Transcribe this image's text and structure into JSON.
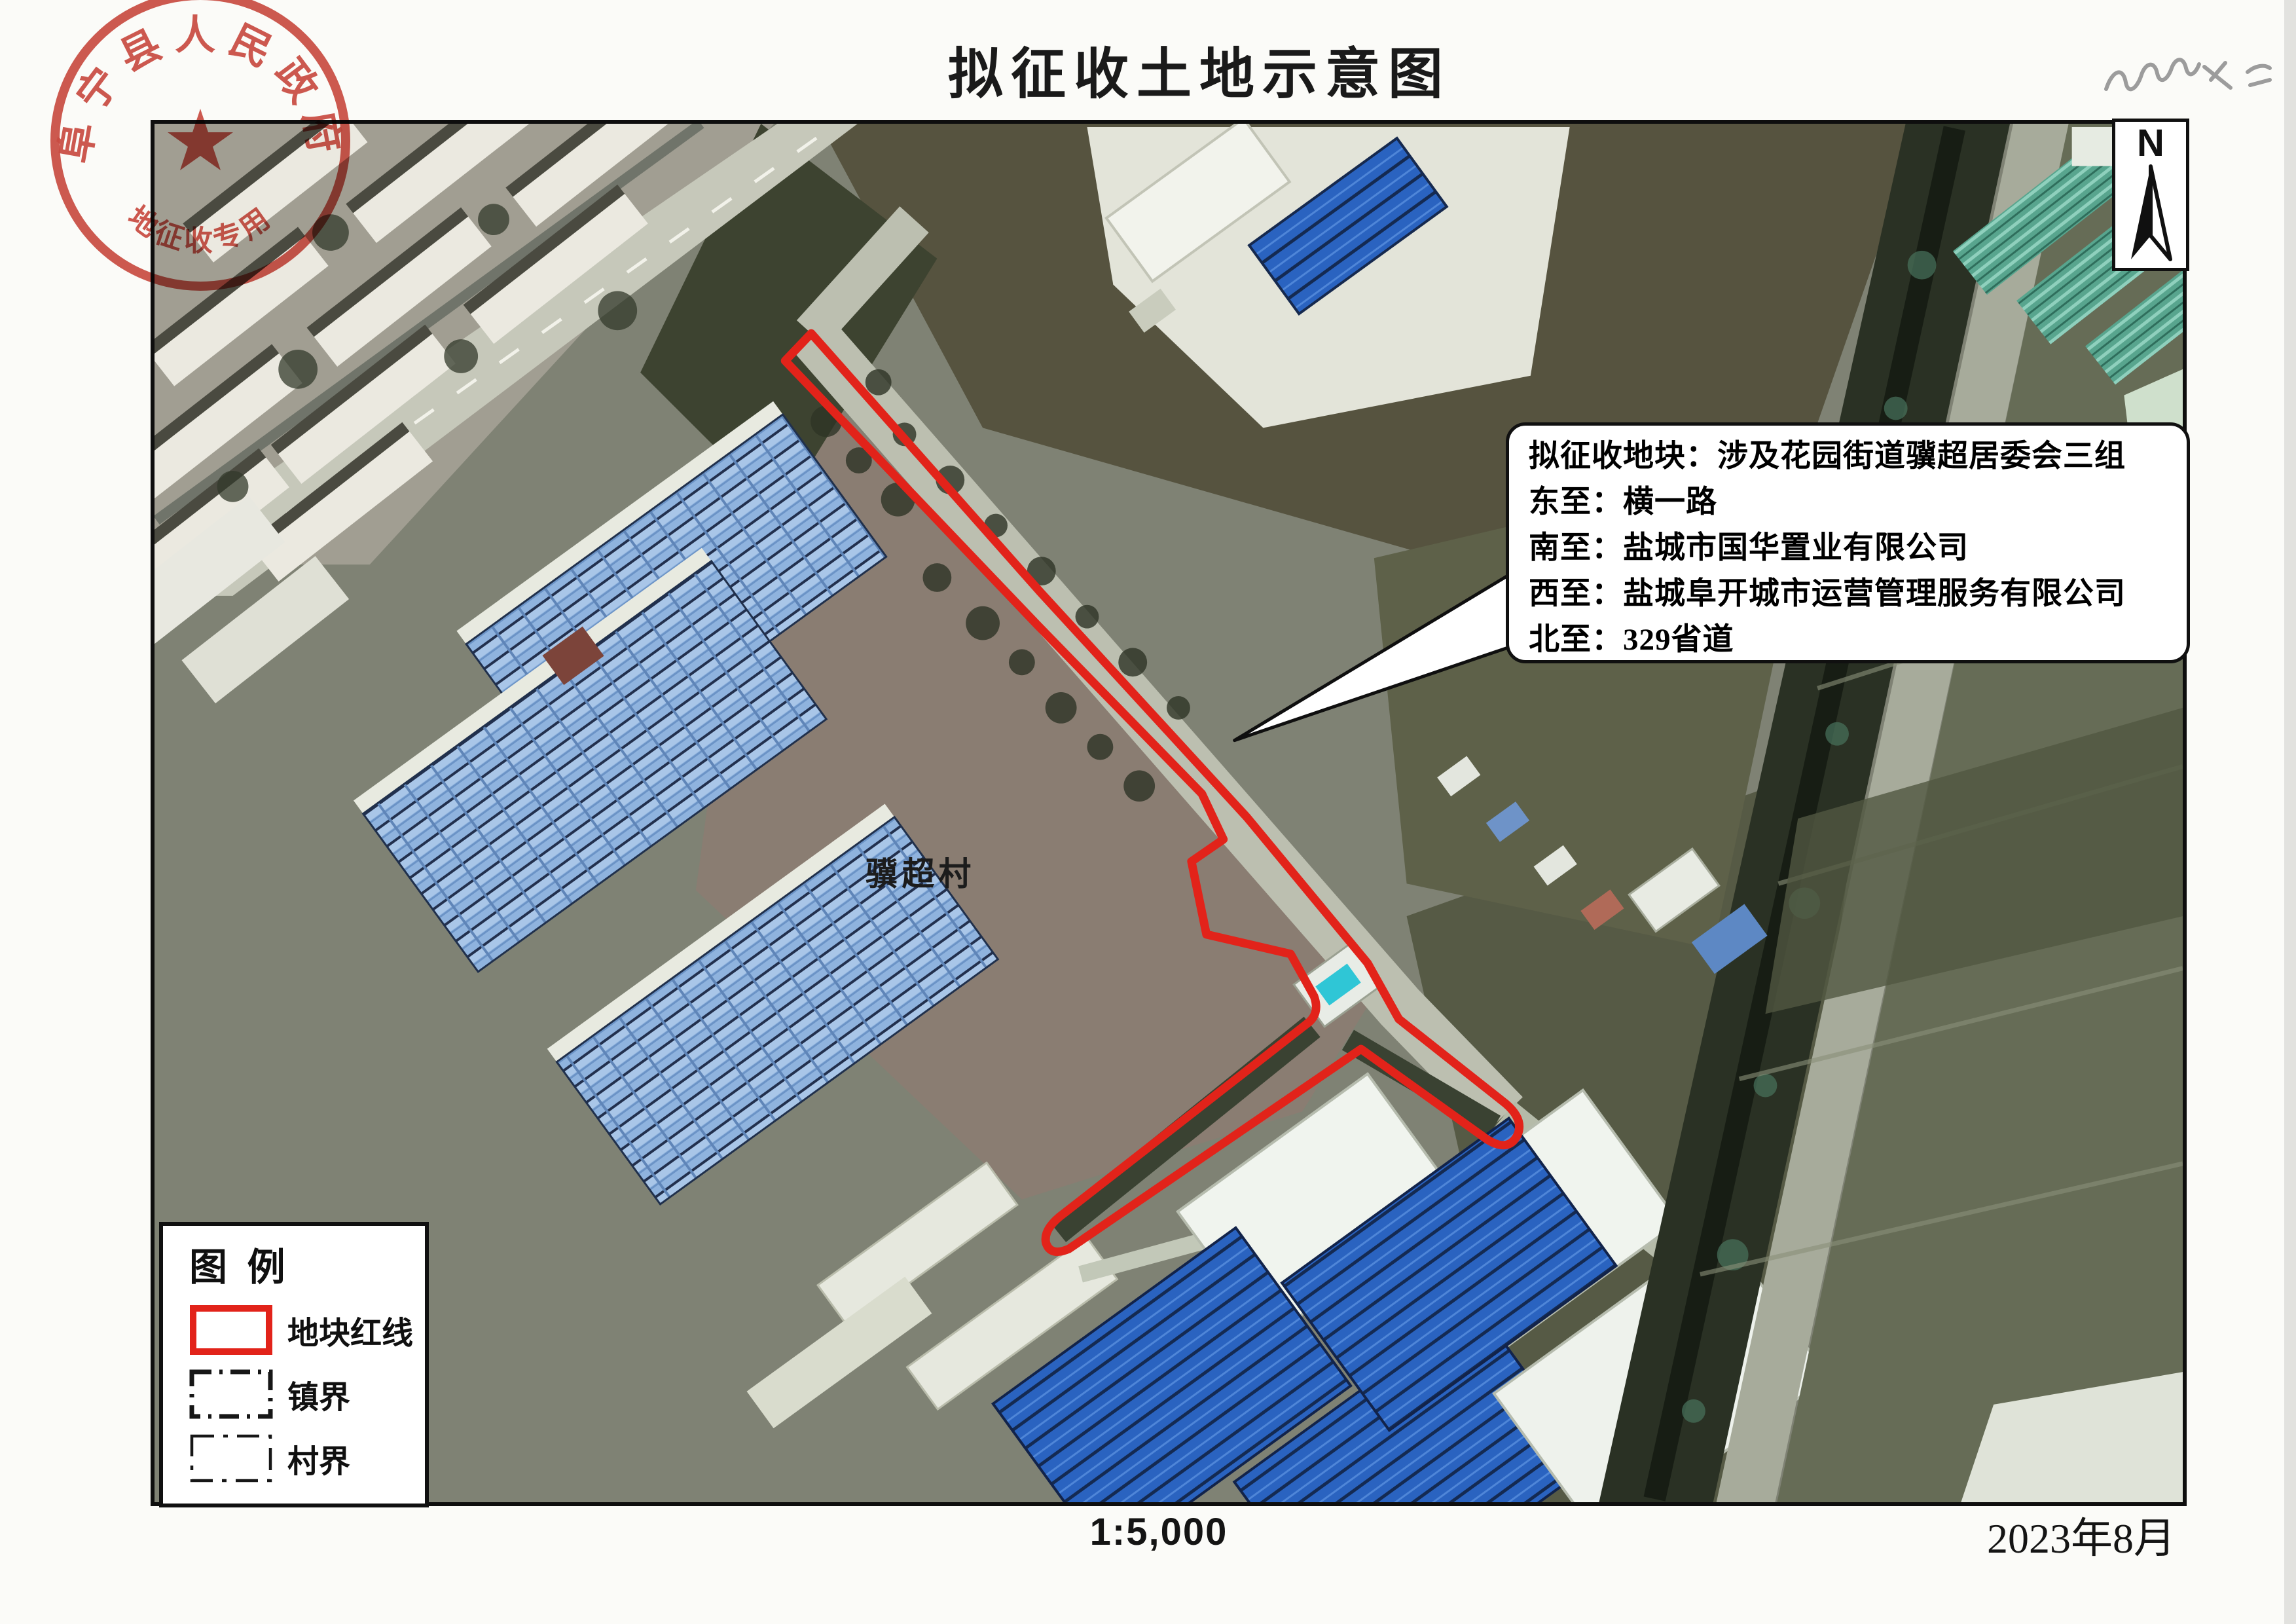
{
  "title": "拟征收土地示意图",
  "footer": {
    "scale": "1:5,000",
    "date": "2023年8月"
  },
  "north_arrow": {
    "label": "N"
  },
  "map": {
    "village_label": "骥超村"
  },
  "callout": {
    "lines": [
      "拟征收地块：涉及花园街道骥超居委会三组",
      "东至：横一路",
      "南至：盐城市国华置业有限公司",
      "西至：盐城阜开城市运营管理服务有限公司",
      "北至：329省道"
    ]
  },
  "legend": {
    "title": "图  例",
    "items": [
      {
        "label": "地块红线",
        "swatch": "red-solid-rect"
      },
      {
        "label": "镇界",
        "swatch": "black-dash-dot-rect"
      },
      {
        "label": "村界",
        "swatch": "black-dash-rect"
      }
    ]
  },
  "seal": {
    "arc_text_top": "阜宁县人民政府",
    "arc_text_bottom": "土地征收专用章",
    "color": "#c7382e"
  },
  "handwritten_note": "七七七大二",
  "colors": {
    "parcel_red_line": "#e2231a",
    "map_border": "#0e0e0e",
    "seal_red": "#c7382e"
  }
}
